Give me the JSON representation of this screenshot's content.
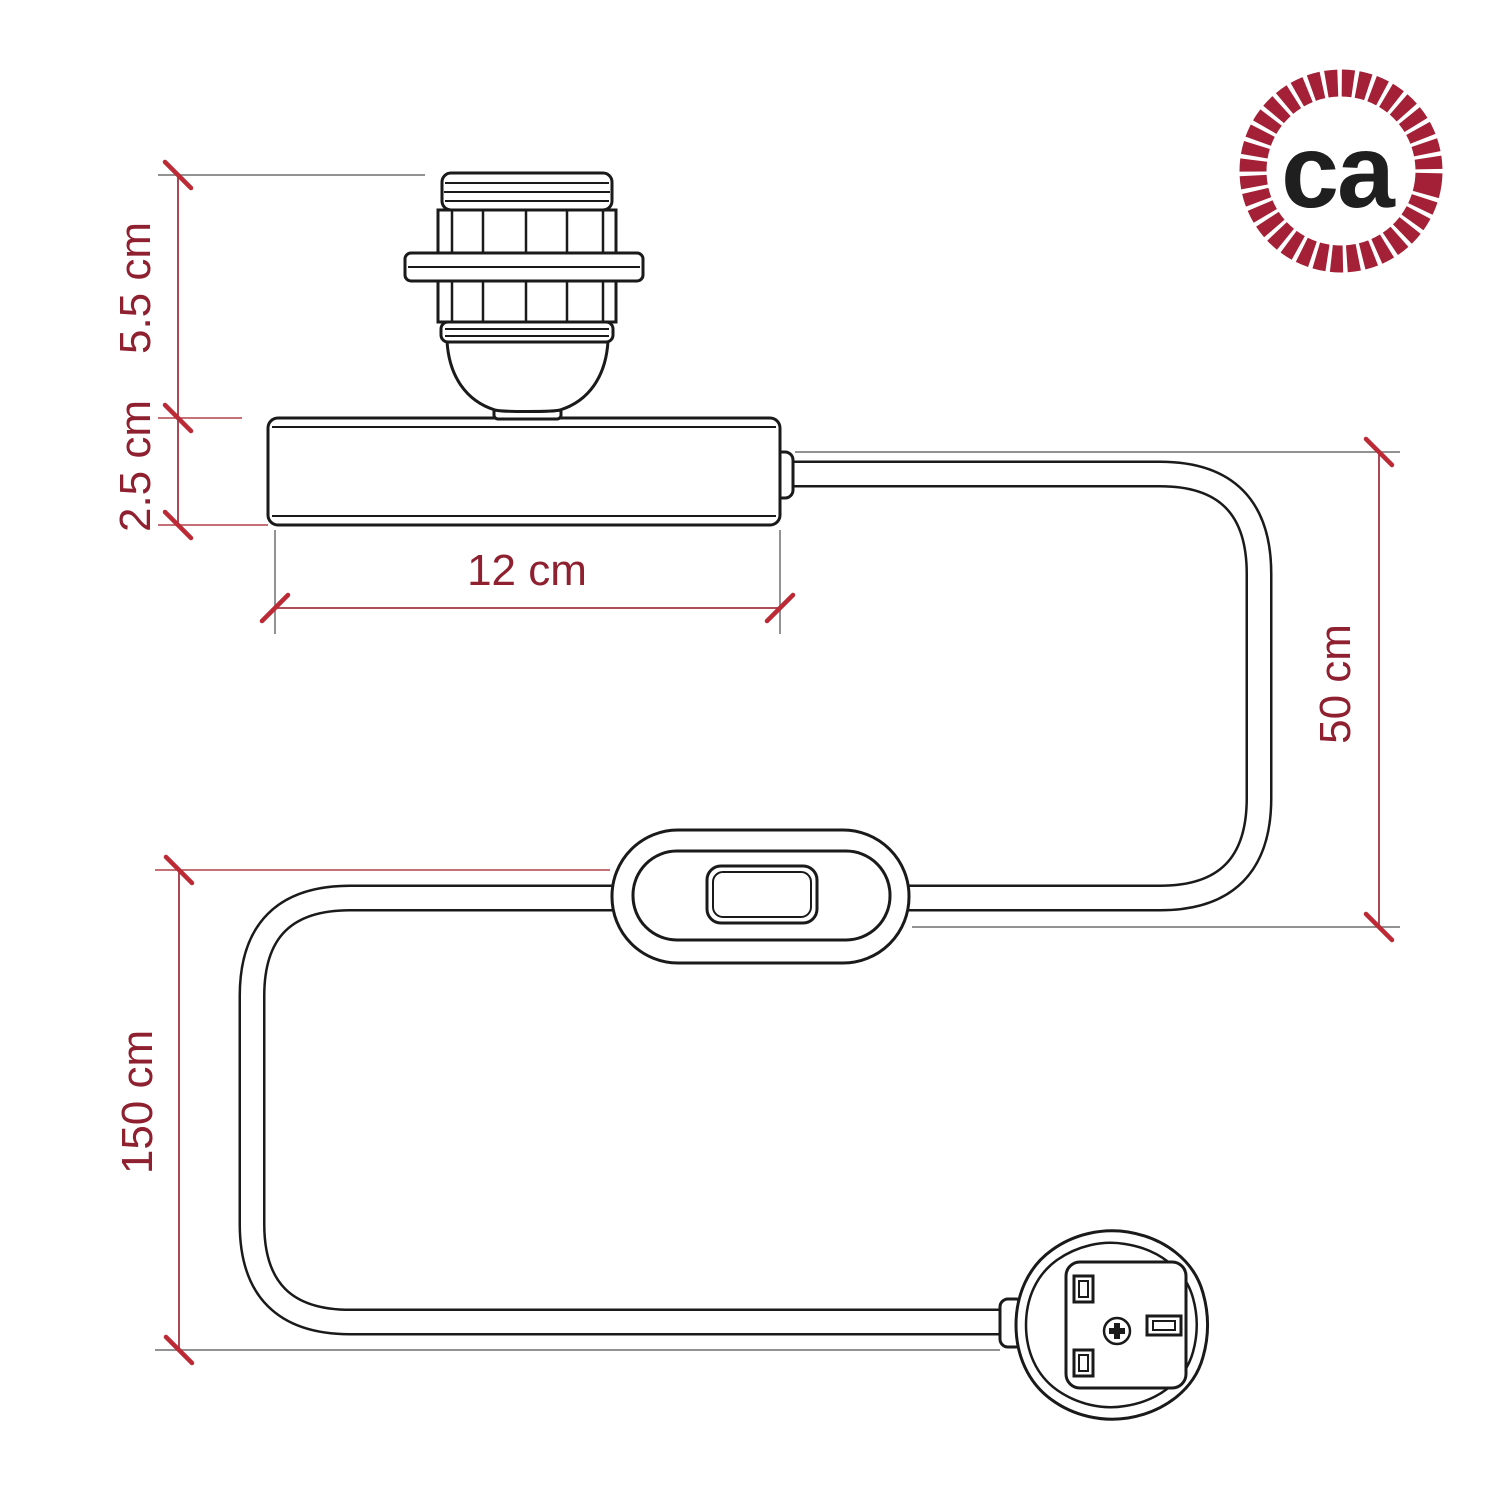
{
  "diagram": {
    "dimensions": {
      "socket_height_label": "5.5 cm",
      "base_height_label": "2.5 cm",
      "base_width_label": "12 cm",
      "base_to_switch_label": "50 cm",
      "switch_to_plug_label": "150 cm"
    },
    "logo": {
      "text": "ca",
      "ring_color": "#a32036",
      "text_color": "#1f1f1f"
    },
    "colors": {
      "drawing_line": "#1a1a1a",
      "dimension_red": "#8e2030",
      "extension_gray": "#6f6f6f",
      "background": "#ffffff"
    }
  }
}
